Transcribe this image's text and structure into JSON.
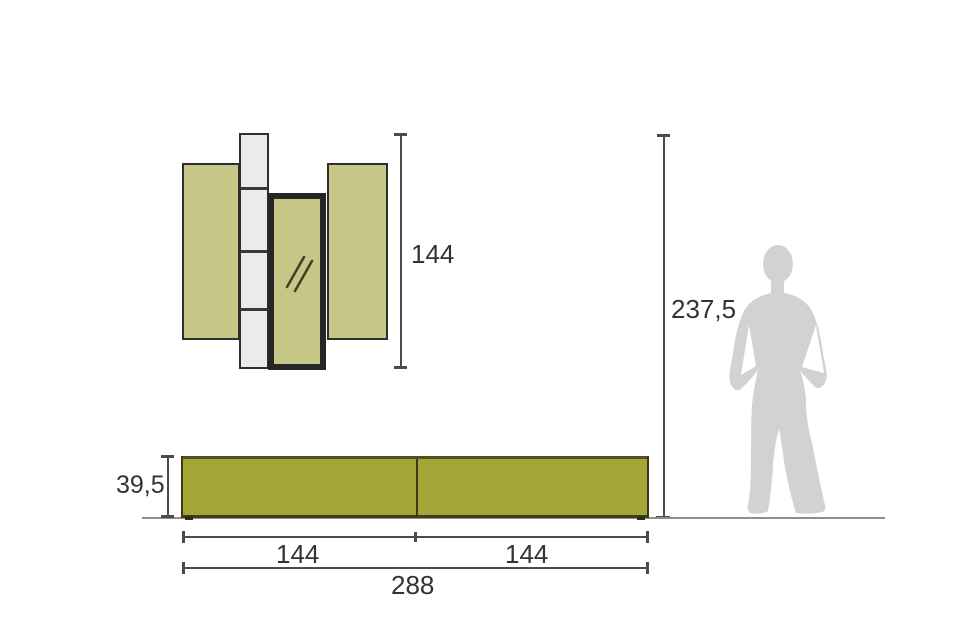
{
  "page": {
    "type": "furniture-dimension-diagram",
    "background": "#ffffff"
  },
  "labels": {
    "wall_height": "144",
    "total_height": "237,5",
    "base_height": "39,5",
    "base_left_width": "144",
    "base_right_width": "144",
    "base_total_width": "288"
  },
  "colors": {
    "panel_olive": "#c6c787",
    "base_olive": "#a4a437",
    "shelf_white": "#ebebed",
    "outline_dark": "#2e2e2e",
    "mirror_frame": "#262626",
    "silhouette_gray": "#d0d2d3",
    "dimension_line": "#4c4c4c",
    "floor_line": "#8e8e8e",
    "text": "#333333"
  },
  "icons": {
    "mirror_glint": "mirror-glint-icon",
    "human_figure": "female-silhouette"
  }
}
